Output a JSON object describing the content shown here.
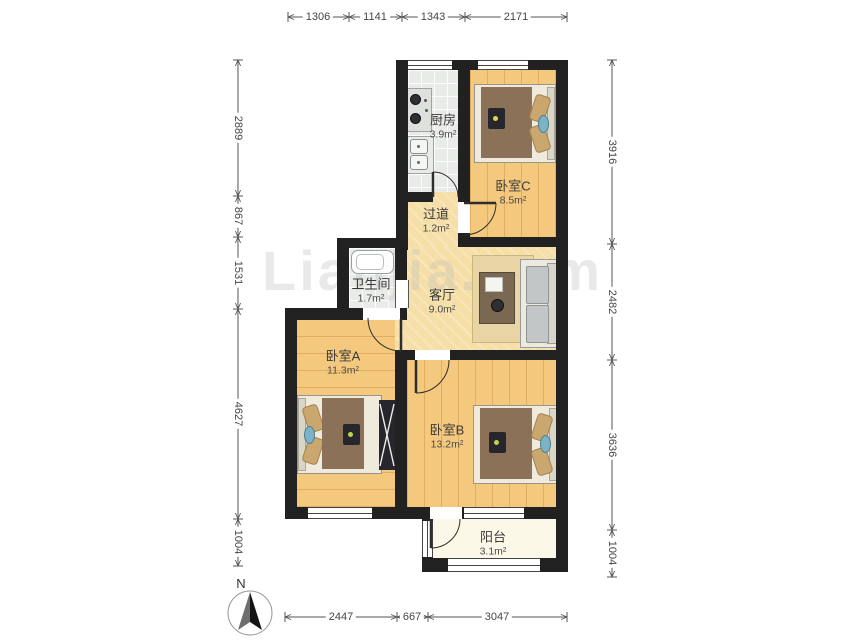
{
  "watermark": {
    "text": "Lianjia.com"
  },
  "compass": {
    "label": "N"
  },
  "rooms": {
    "kitchen": {
      "name": "厨房",
      "area": "3.9m²"
    },
    "bedroom_c": {
      "name": "卧室C",
      "area": "8.5m²"
    },
    "hallway": {
      "name": "过道",
      "area": "1.2m²"
    },
    "bathroom": {
      "name": "卫生间",
      "area": "1.7m²"
    },
    "living_room": {
      "name": "客厅",
      "area": "9.0m²"
    },
    "bedroom_a": {
      "name": "卧室A",
      "area": "11.3m²"
    },
    "bedroom_b": {
      "name": "卧室B",
      "area": "13.2m²"
    },
    "balcony": {
      "name": "阳台",
      "area": "3.1m²"
    }
  },
  "dimensions": {
    "top": [
      "1306",
      "1141",
      "1343",
      "2171"
    ],
    "left": [
      "2889",
      "867",
      "1531",
      "4627",
      "1004"
    ],
    "right": [
      "3916",
      "2482",
      "3636",
      "1004"
    ],
    "bottom": [
      "2447",
      "667",
      "3047"
    ]
  }
}
